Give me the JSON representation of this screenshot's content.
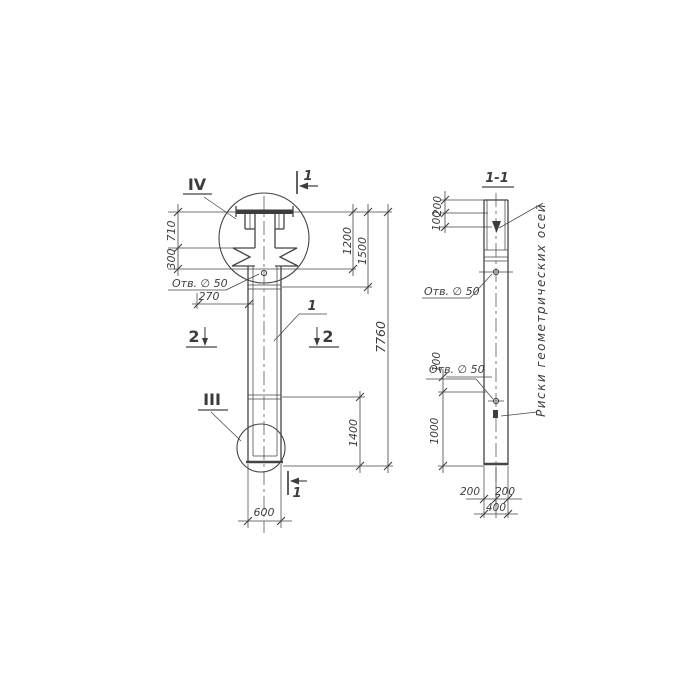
{
  "colors": {
    "ink": "#454545",
    "paper": "#ffffff"
  },
  "left_view": {
    "detail_marker_top": "IV",
    "detail_marker_bottom": "III",
    "cut_label_1": "1",
    "cut_label_2": "2",
    "part_ref": "1",
    "hole_note": "Отв. ∅ 50",
    "dims": {
      "d710": "710",
      "d300": "300",
      "d270": "270",
      "d1200": "1200",
      "d1500": "1500",
      "d7760": "7760",
      "d1400": "1400",
      "d600": "600"
    }
  },
  "section_view": {
    "title": "1-1",
    "hole_note_upper": "Отв. ∅ 50",
    "hole_note_lower": "Отв. ∅ 50",
    "axes_note": "Риски геометрических осей",
    "dims": {
      "d200_top": "200",
      "d100_top": "100",
      "d100_mid": "100",
      "d1000": "1000",
      "d200_bottom_left": "200",
      "d200_bottom_right": "200",
      "d400": "400"
    }
  }
}
